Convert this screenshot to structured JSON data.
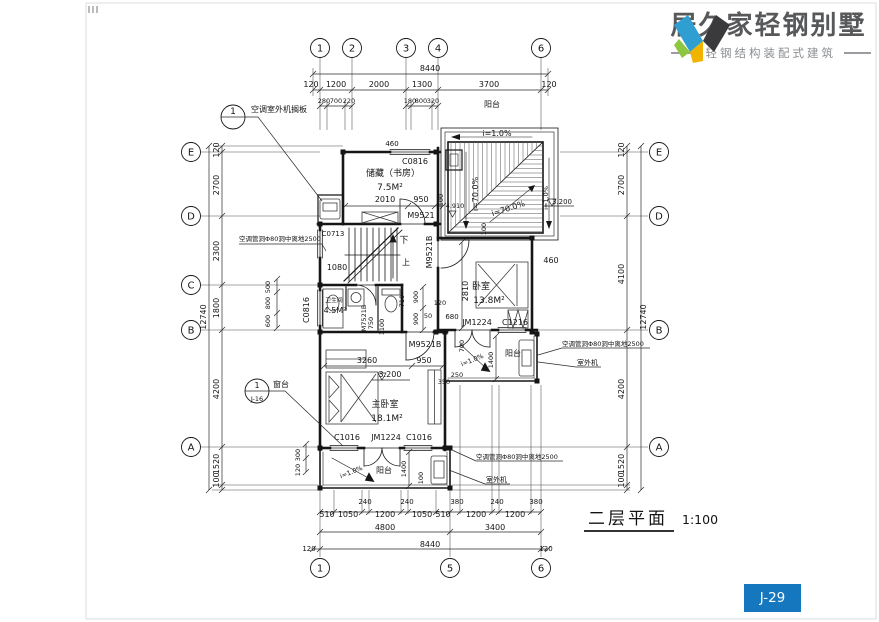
{
  "brand": {
    "name": "居久家轻钢别墅",
    "tagline": "轻钢结构装配式建筑",
    "colors": {
      "blue": "#2E9FD0",
      "green": "#8DC63F",
      "yellow": "#F0B400",
      "dark": "#3A3A3C",
      "text": "#57585A"
    }
  },
  "sheet": {
    "number": "J-29",
    "badge_color": "#1577BD"
  },
  "plan_title": {
    "name": "二层平面",
    "scale": "1:100"
  },
  "axes": {
    "top": [
      "1",
      "2",
      "3",
      "4",
      "6"
    ],
    "bottom": [
      "1",
      "5",
      "6"
    ],
    "left": [
      "E",
      "D",
      "C",
      "B",
      "A"
    ],
    "right": [
      "E",
      "D",
      "B",
      "A"
    ]
  },
  "dims": {
    "top": {
      "total": "8440",
      "main": [
        "120",
        "1200",
        "2000",
        "1300",
        "3700",
        "120"
      ],
      "sub_left": [
        "280",
        "700",
        "220"
      ],
      "sub_mid": [
        "180",
        "800",
        "320"
      ],
      "balcony": "阳台"
    },
    "bottom": {
      "main": [
        "510",
        "1050",
        "240",
        "1200",
        "240",
        "1050",
        "510",
        "380",
        "1200",
        "240",
        "1200",
        "380"
      ],
      "groups": [
        "4800",
        "3400"
      ],
      "total": "8440",
      "edge_left": "120",
      "edge_right": "120"
    },
    "left": {
      "total": "12740",
      "main": [
        "120",
        "2700",
        "2300",
        "1800",
        "4200",
        "1520",
        "100"
      ],
      "inner": [
        "500",
        "800",
        "600"
      ],
      "corner": [
        "300",
        "120"
      ]
    },
    "right": {
      "total": "12740",
      "main": [
        "120",
        "2700",
        "4100",
        "4200",
        "1520",
        "100"
      ]
    }
  },
  "rooms": {
    "storage": {
      "name": "储藏（书房）",
      "area": "7.5M²"
    },
    "bedroom": {
      "name": "卧室",
      "area": "13.8M²"
    },
    "master": {
      "name": "主卧室",
      "area": "18.1M²"
    },
    "bath": {
      "name": "卫生间",
      "area": "4.5M²"
    },
    "balcony": "阳台",
    "down": "下",
    "up": "上"
  },
  "openings": {
    "c0816": "C0816",
    "c0713": "C0713",
    "c1016": "C1016",
    "c1216": "C1216",
    "jm1224": "JM1224",
    "m9521": "M9521",
    "m9521b": "M9521B",
    "m7521b": "M7521B"
  },
  "slopes": {
    "i1": "i=1.0%",
    "i70": "i=70.0%"
  },
  "levels": {
    "v32": "3.200",
    "v49": "4.910"
  },
  "notes": {
    "ac_shelf": "空调室外机搁板",
    "ac_hole": "空调管洞Φ80洞中离地2500",
    "outdoor": "室外机",
    "sill": "窗台",
    "callout1_no": "1",
    "callout2_no": "1",
    "callout2_ref": "J-16"
  },
  "plan_dims": {
    "d2010": "2010",
    "d950": "950",
    "d100": "100",
    "d460": "460",
    "d1080": "1080",
    "d2810": "2810",
    "d680": "680",
    "d120": "120",
    "d50": "50",
    "d900": "900",
    "d750": "750",
    "d1100": "1100",
    "d710": "710",
    "d3260": "3260",
    "d350": "350",
    "d250": "250",
    "d700": "700",
    "d1400": "1400"
  }
}
